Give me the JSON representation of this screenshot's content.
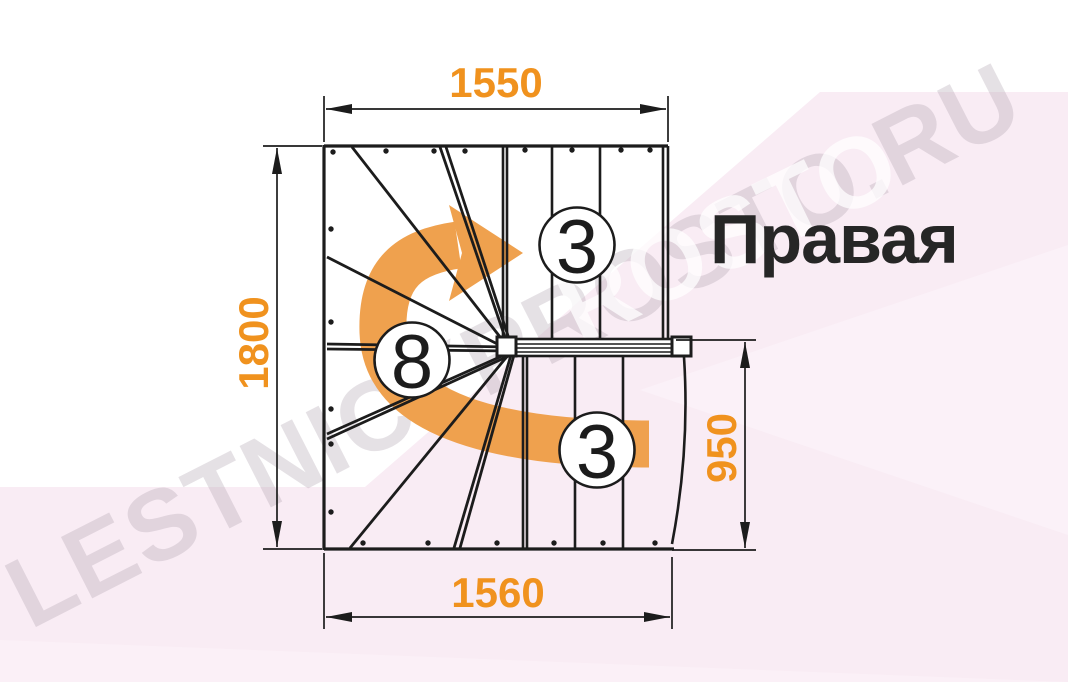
{
  "title": {
    "label": "Правая"
  },
  "dimensions": {
    "top_width": "1550",
    "left_height": "1800",
    "right_height": "950",
    "bottom_width": "1560"
  },
  "steps": {
    "top_flight_count": "3",
    "winder_count": "8",
    "bottom_flight_count": "3"
  },
  "watermark": {
    "text": "LESTNICYPROSTO.RU",
    "fragment": "ROSTO"
  },
  "colors": {
    "dimension_orange": "#F0921E",
    "arrow_orange": "#EFA14E",
    "line_color": "#1C1C1C",
    "title_color": "#262626",
    "bg_pink": "#F9ECF4"
  }
}
